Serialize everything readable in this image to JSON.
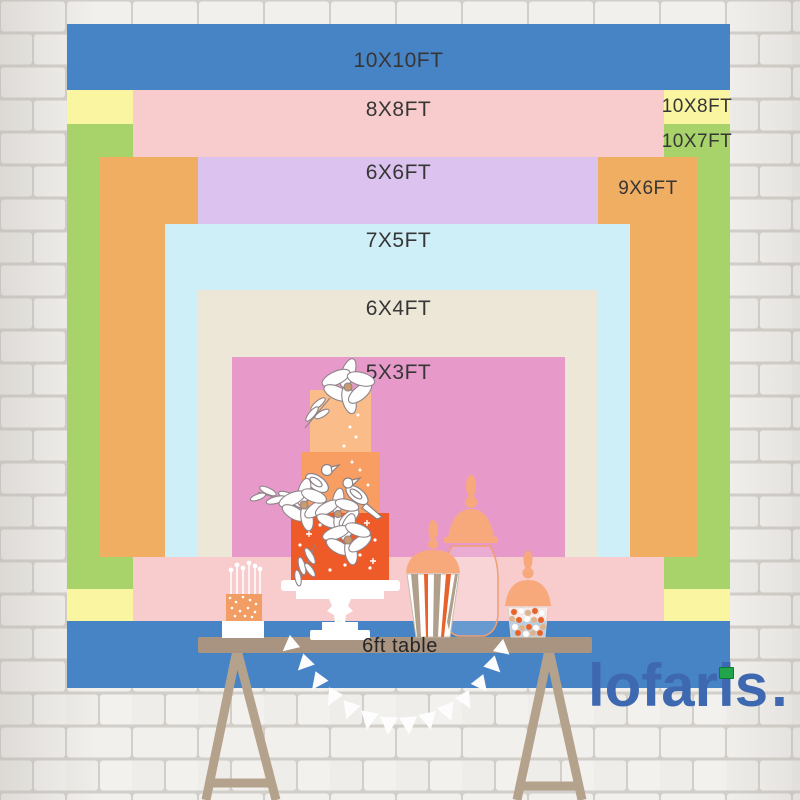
{
  "brand": {
    "logo_text": "lofaris",
    "logo_suffix": ".",
    "logo_color": "#3e68b0",
    "logo_accent_green": "#22a44b"
  },
  "backdrop": {
    "table_label": "6ft table",
    "sizes": [
      {
        "label": "10X10FT",
        "color": "#4784c6"
      },
      {
        "label": "10X8FT",
        "color": "#f9f5a1"
      },
      {
        "label": "10X7FT",
        "color": "#a7d36a"
      },
      {
        "label": "8X8FT",
        "color": "#f8cbcd"
      },
      {
        "label": "9X6FT",
        "color": "#f0ae62"
      },
      {
        "label": "6X6FT",
        "color": "#dcc3ef"
      },
      {
        "label": "7X5FT",
        "color": "#cfeff8"
      },
      {
        "label": "6X4FT",
        "color": "#ede7d7"
      },
      {
        "label": "5X3FT",
        "color": "#e79aca"
      }
    ]
  },
  "illustration": {
    "items": [
      "trestle-table",
      "bunting-garland",
      "mini-candle-cake",
      "three-tier-cake",
      "apothecary-jar",
      "popcorn-jar",
      "candy-jar"
    ],
    "accent_colors": {
      "cake_top": "#fabd8a",
      "cake_mid": "#f89e63",
      "cake_bottom": "#ee5b28",
      "jar_lid": "#f8a97c",
      "table_wood": "#a89480",
      "leg_wood": "#b4a28c",
      "candy_orange": "#e8632c",
      "candy_tan": "#d9b48f"
    }
  }
}
